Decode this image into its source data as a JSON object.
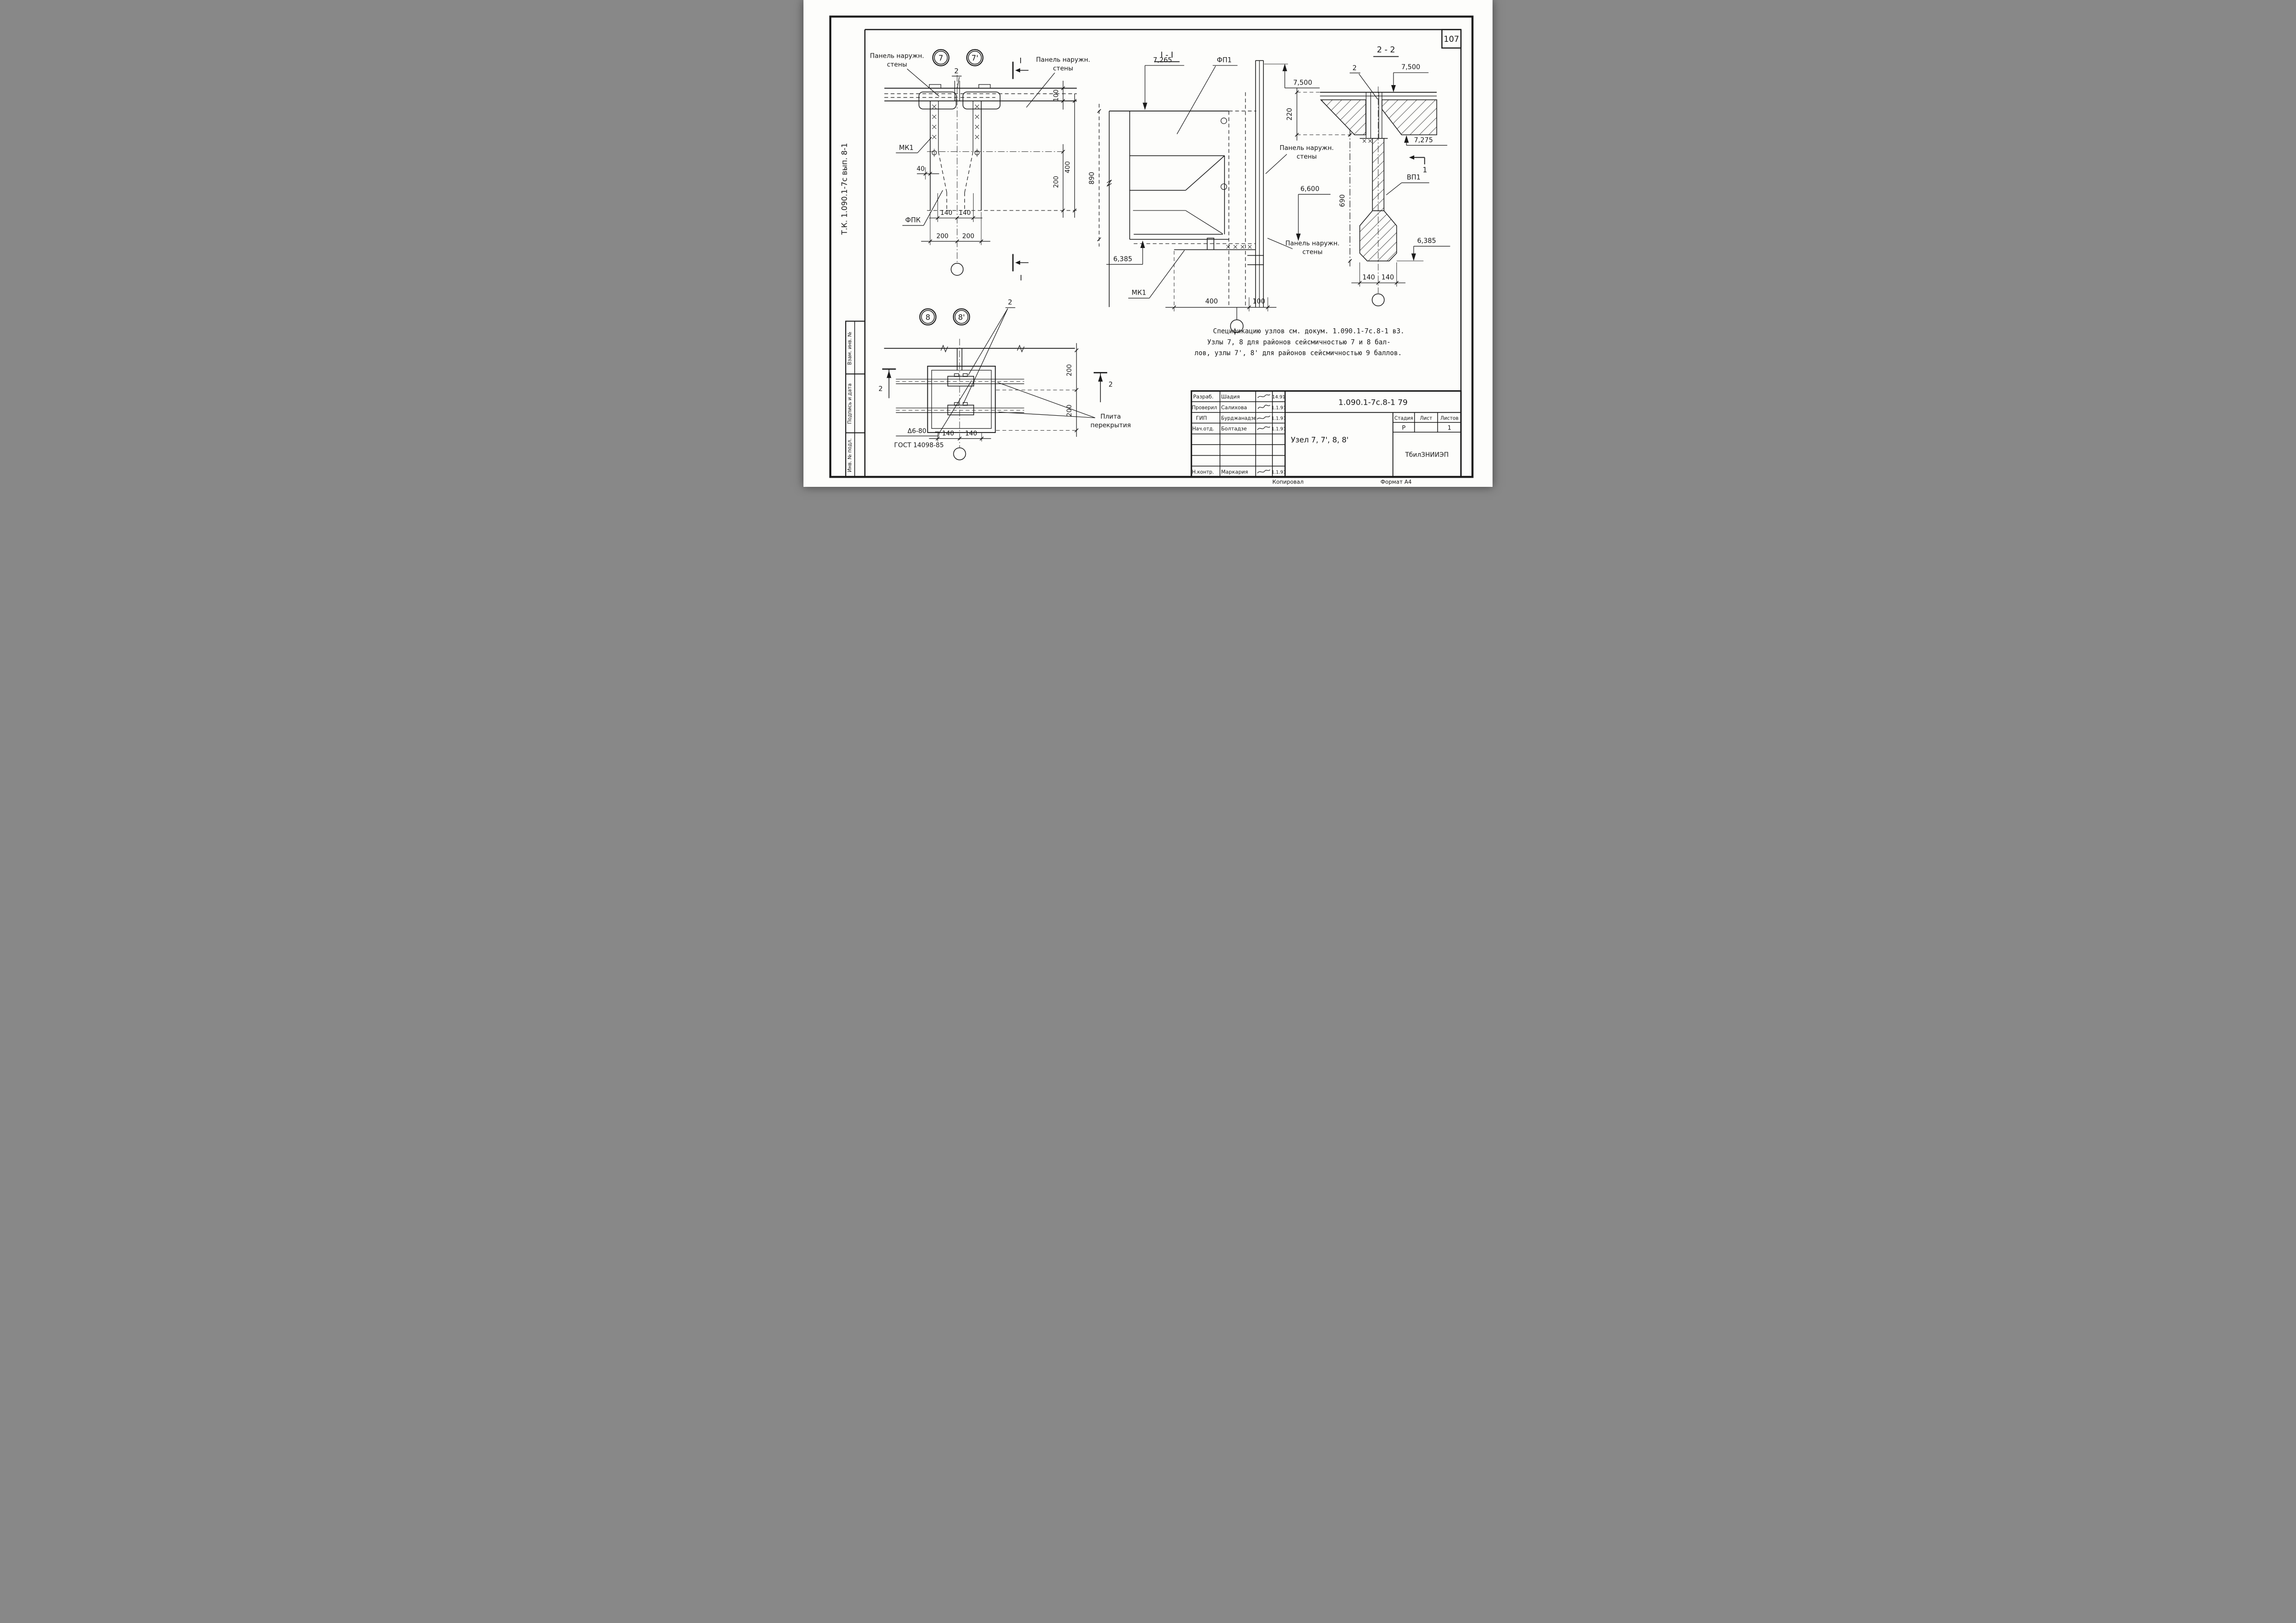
{
  "frame": {
    "page_number": "107",
    "album_code": "Т.К. 1.090.1-7с  вып. 8-1",
    "margin_box_labels": [
      "Взам. инв. №",
      "Подпись и дата",
      "Инв. № подл."
    ],
    "footer_copied": "Копировал",
    "footer_format": "Формат А4"
  },
  "node7_plan": {
    "bubble_left": "7",
    "bubble_right": "7'",
    "callout_2": "2",
    "section_mark": "I",
    "panel_label_line1": "Панель наружн.",
    "panel_label_line2": "стены",
    "mk1": "МК1",
    "fpk": "ФПК",
    "dim_40": "40",
    "dim_100": "100",
    "dim_400": "400",
    "dim_200": "200",
    "dim_140": "140"
  },
  "node8_plan": {
    "bubble_left": "8",
    "bubble_right": "8'",
    "callout_2": "2",
    "section_mark": "2",
    "dim_200": "200",
    "dim_140": "140",
    "weld_mark": "Δ6-80",
    "weld_gost": "ГОСТ 14098-85",
    "slab_label_line1": "Плита",
    "slab_label_line2": "перекрытия"
  },
  "section_I_I": {
    "title": "I - I",
    "elev_top": "7,265",
    "fp1": "ФП1",
    "elev_wall_top": "7,500",
    "dim_890": "890",
    "panel_label_line1": "Панель наружн.",
    "panel_label_line2": "стены",
    "elev_mid": "6,600",
    "elev_bottom": "6,385",
    "mk1": "МК1",
    "dim_400": "400",
    "dim_100": "100"
  },
  "section_2_2": {
    "title": "2 - 2",
    "callout_2": "2",
    "elev_top": "7,500",
    "dim_220": "220",
    "elev_slab_bottom": "7,275",
    "vp1": "ВП1",
    "section_mark_1": "1",
    "dim_690": "690",
    "elev_bottom": "6,385",
    "dim_140": "140"
  },
  "note": {
    "line1": "Спецификацию узлов см. докум. 1.090.1-7с.8-1 вЗ.",
    "line2": "Узлы 7, 8 для районов сейсмичностью 7 и 8 бал-",
    "line3": "лов, узлы 7', 8' для районов сейсмичностью 9 баллов."
  },
  "title_block": {
    "doc_number": "1.090.1-7с.8-1  79",
    "object_title": "Узел 7, 7', 8, 8'",
    "stage_label": "Стадия",
    "sheet_label": "Лист",
    "sheets_label": "Листов",
    "stage_value": "Р",
    "sheet_value": "",
    "sheets_value": "1",
    "institute": "ТбилЗНИИЭП",
    "rows": [
      {
        "role": "Разраб.",
        "name": "Шадия",
        "date": "14.91"
      },
      {
        "role": "Проверил",
        "name": "Салихова",
        "date": "1.1.91"
      },
      {
        "role": "ГИП",
        "name": "Бурджанадзе",
        "date": "1.1.91"
      },
      {
        "role": "Нач.отд.",
        "name": "Болтадзе",
        "date": "1.1.91"
      },
      {
        "role": "Н.контр.",
        "name": "Маркария",
        "date": "1.1.91"
      }
    ]
  }
}
